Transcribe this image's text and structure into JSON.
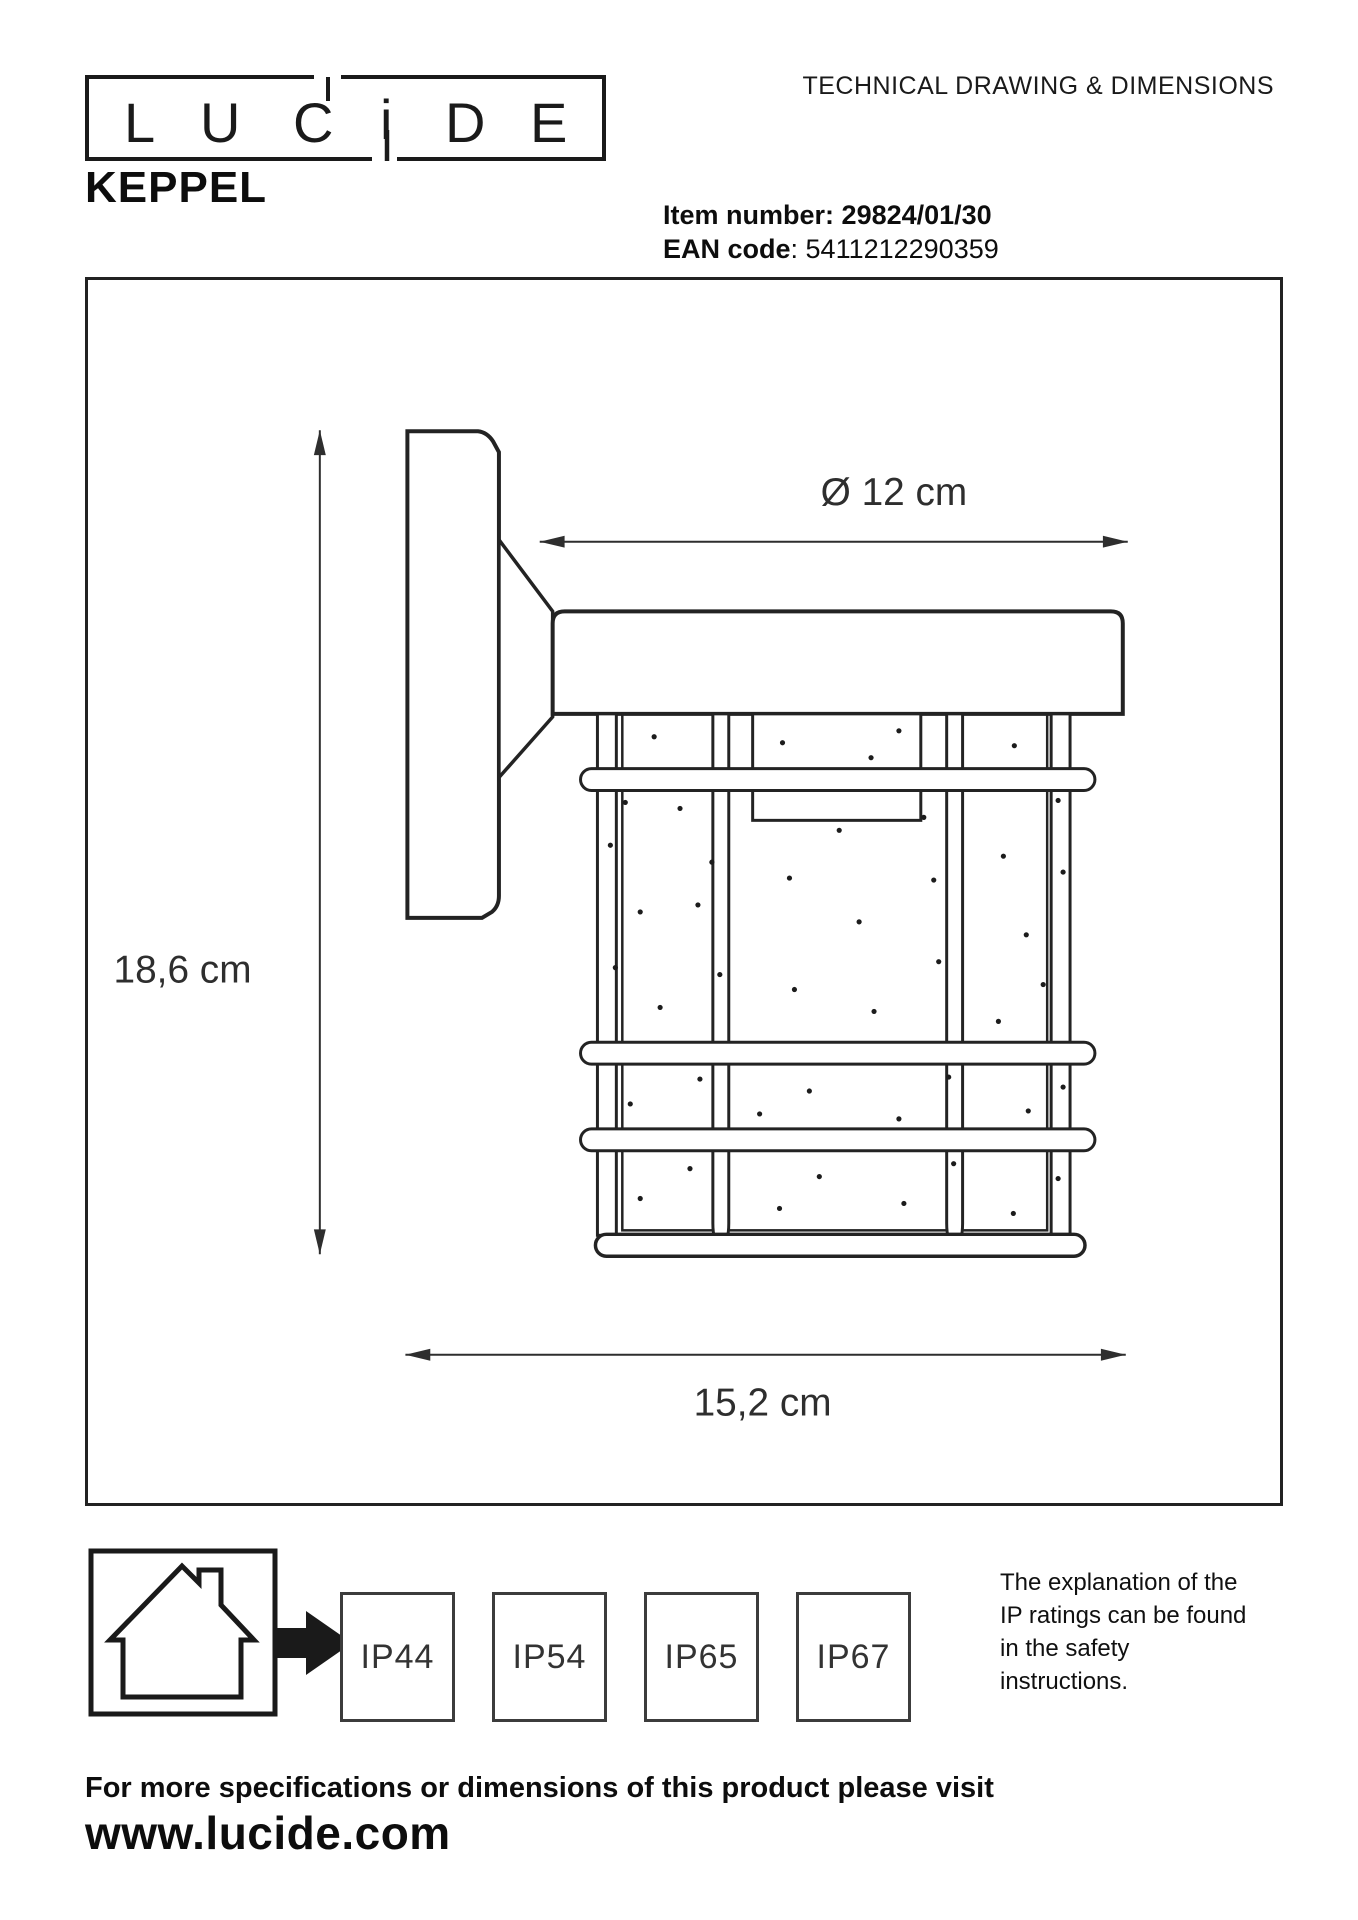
{
  "header": {
    "doc_title": "TECHNICAL DRAWING & DIMENSIONS"
  },
  "logo": {
    "letters": [
      "L",
      "U",
      "C",
      "i",
      "D",
      "E"
    ]
  },
  "product": {
    "name": "KEPPEL",
    "item_label": "Item number:",
    "item_value": "29824/01/30",
    "ean_label": "EAN code",
    "ean_value": ": 5411212290359"
  },
  "drawing": {
    "width_label": "Ø 12 cm",
    "height_label": "18,6 cm",
    "depth_label": "15,2 cm",
    "speckles": [
      [
        654,
        736
      ],
      [
        783,
        742
      ],
      [
        900,
        730
      ],
      [
        872,
        757
      ],
      [
        1016,
        745
      ],
      [
        625,
        802
      ],
      [
        680,
        808
      ],
      [
        840,
        830
      ],
      [
        925,
        817
      ],
      [
        1060,
        800
      ],
      [
        610,
        845
      ],
      [
        712,
        862
      ],
      [
        790,
        878
      ],
      [
        935,
        880
      ],
      [
        1005,
        856
      ],
      [
        1065,
        872
      ],
      [
        640,
        912
      ],
      [
        698,
        905
      ],
      [
        860,
        922
      ],
      [
        1028,
        935
      ],
      [
        615,
        968
      ],
      [
        720,
        975
      ],
      [
        795,
        990
      ],
      [
        940,
        962
      ],
      [
        1045,
        985
      ],
      [
        660,
        1008
      ],
      [
        875,
        1012
      ],
      [
        1000,
        1022
      ],
      [
        700,
        1080
      ],
      [
        810,
        1092
      ],
      [
        950,
        1078
      ],
      [
        1065,
        1088
      ],
      [
        630,
        1105
      ],
      [
        760,
        1115
      ],
      [
        900,
        1120
      ],
      [
        1030,
        1112
      ],
      [
        690,
        1170
      ],
      [
        820,
        1178
      ],
      [
        955,
        1165
      ],
      [
        1060,
        1180
      ],
      [
        640,
        1200
      ],
      [
        780,
        1210
      ],
      [
        905,
        1205
      ],
      [
        1015,
        1215
      ]
    ]
  },
  "ip": {
    "ratings": [
      "IP44",
      "IP54",
      "IP65",
      "IP67"
    ],
    "note_lines": [
      "The explanation of the",
      "IP ratings can be found",
      "in the safety",
      "instructions."
    ]
  },
  "footer": {
    "visit_text": "For more specifications or dimensions of this product please visit",
    "website": "www.lucide.com"
  }
}
